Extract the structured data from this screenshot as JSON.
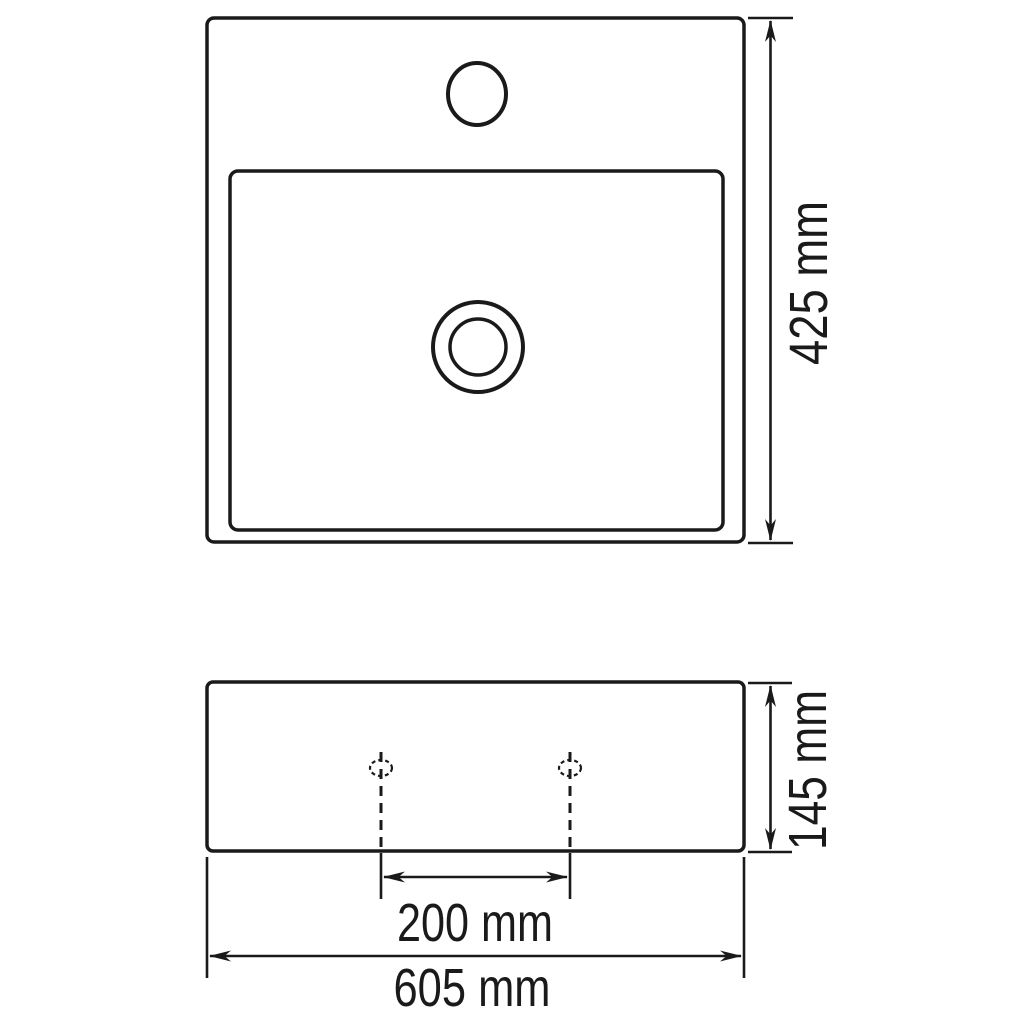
{
  "page": {
    "background_color": "#ffffff",
    "line_color": "#1a1a1a",
    "description": "Technical dimension drawing of a square ceramic washbasin with faucet hole: plan view (top) and front view (bottom)"
  },
  "views": {
    "top_view": {
      "name": "plan view of basin",
      "dim_depth": {
        "label": "425 mm"
      }
    },
    "front_view": {
      "name": "front view of basin",
      "dim_height": {
        "label": "145 mm"
      },
      "dim_hole_spacing": {
        "label": "200 mm"
      },
      "dim_width": {
        "label": "605 mm"
      }
    }
  }
}
